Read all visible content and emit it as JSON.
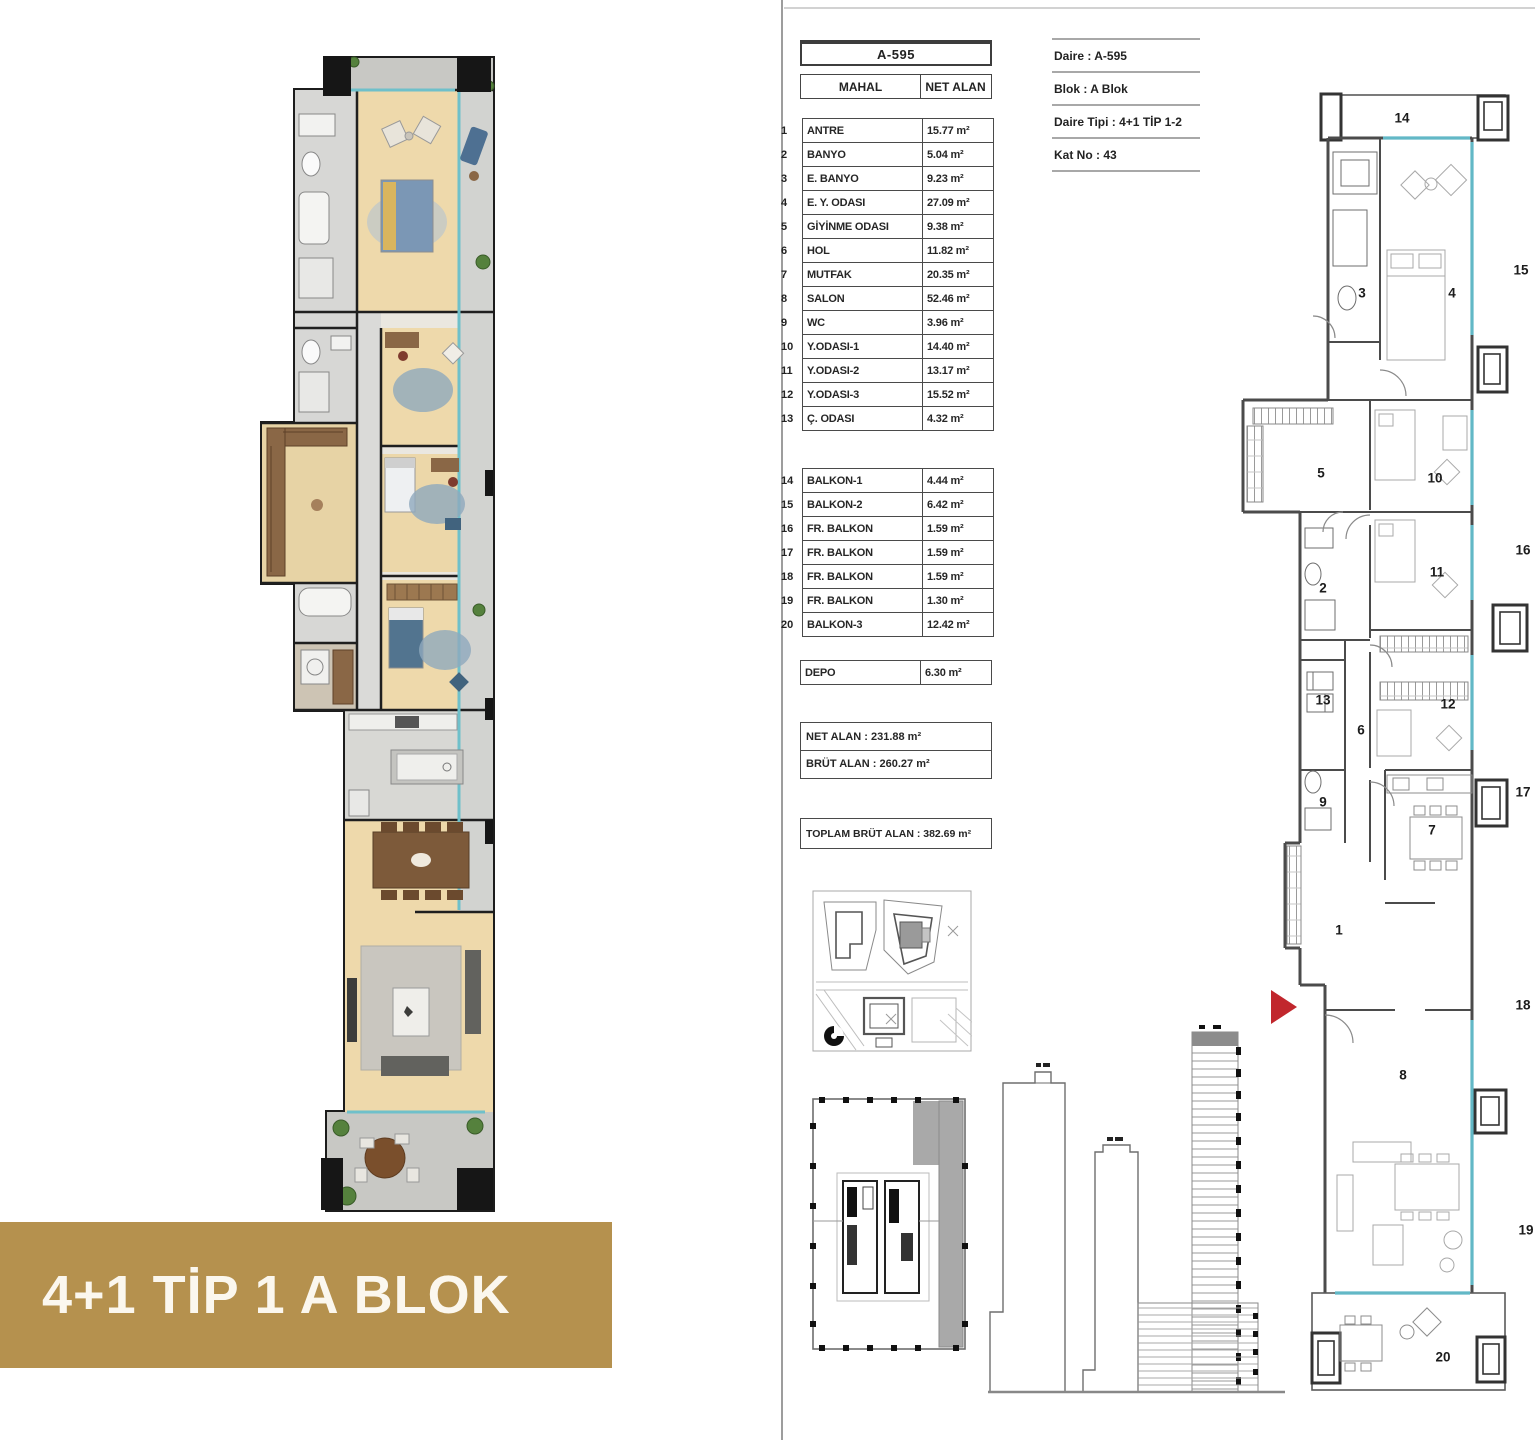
{
  "banner": {
    "text": "4+1 TİP 1  A BLOK",
    "bg": "#b5914e",
    "fg": "#fbf7ee"
  },
  "room_table": {
    "unit_code": "A-595",
    "columns": {
      "mahal": "MAHAL",
      "net_alan": "NET ALAN"
    },
    "rows": [
      {
        "no": "1",
        "name": "ANTRE",
        "area": "15.77 m²"
      },
      {
        "no": "2",
        "name": "BANYO",
        "area": "5.04 m²"
      },
      {
        "no": "3",
        "name": "E. BANYO",
        "area": "9.23 m²"
      },
      {
        "no": "4",
        "name": "E. Y. ODASI",
        "area": "27.09 m²"
      },
      {
        "no": "5",
        "name": "GİYİNME ODASI",
        "area": "9.38 m²"
      },
      {
        "no": "6",
        "name": "HOL",
        "area": "11.82 m²"
      },
      {
        "no": "7",
        "name": "MUTFAK",
        "area": "20.35 m²"
      },
      {
        "no": "8",
        "name": "SALON",
        "area": "52.46 m²"
      },
      {
        "no": "9",
        "name": "WC",
        "area": "3.96 m²"
      },
      {
        "no": "10",
        "name": "Y.ODASI-1",
        "area": "14.40 m²"
      },
      {
        "no": "11",
        "name": "Y.ODASI-2",
        "area": "13.17 m²"
      },
      {
        "no": "12",
        "name": "Y.ODASI-3",
        "area": "15.52 m²"
      },
      {
        "no": "13",
        "name": "Ç. ODASI",
        "area": "4.32 m²"
      }
    ],
    "balcony_rows": [
      {
        "no": "14",
        "name": "BALKON-1",
        "area": "4.44 m²"
      },
      {
        "no": "15",
        "name": "BALKON-2",
        "area": "6.42 m²"
      },
      {
        "no": "16",
        "name": "FR. BALKON",
        "area": "1.59 m²"
      },
      {
        "no": "17",
        "name": "FR. BALKON",
        "area": "1.59 m²"
      },
      {
        "no": "18",
        "name": "FR. BALKON",
        "area": "1.59 m²"
      },
      {
        "no": "19",
        "name": "FR. BALKON",
        "area": "1.30 m²"
      },
      {
        "no": "20",
        "name": "BALKON-3",
        "area": "12.42 m²"
      }
    ],
    "depo_row": {
      "name": "DEPO",
      "area": "6.30 m²"
    },
    "summary": {
      "net": "NET ALAN : 231.88 m²",
      "brut": "BRÜT ALAN : 260.27 m²",
      "toplam": "TOPLAM BRÜT ALAN : 382.69 m²"
    }
  },
  "info_panel": {
    "daire": "Daire : A-595",
    "blok": "Blok : A Blok",
    "daire_tipi": "Daire Tipi : 4+1 TİP 1-2",
    "kat_no": "Kat No : 43"
  },
  "right_plan": {
    "entrance_color": "#c1272d",
    "labels": [
      {
        "t": "14",
        "x": 207,
        "y": 38
      },
      {
        "t": "15",
        "x": 326,
        "y": 190
      },
      {
        "t": "3",
        "x": 167,
        "y": 213
      },
      {
        "t": "4",
        "x": 257,
        "y": 213
      },
      {
        "t": "5",
        "x": 126,
        "y": 393
      },
      {
        "t": "10",
        "x": 240,
        "y": 398
      },
      {
        "t": "2",
        "x": 128,
        "y": 508
      },
      {
        "t": "11",
        "x": 242,
        "y": 492
      },
      {
        "t": "16",
        "x": 328,
        "y": 470
      },
      {
        "t": "13",
        "x": 128,
        "y": 620
      },
      {
        "t": "6",
        "x": 166,
        "y": 650
      },
      {
        "t": "12",
        "x": 253,
        "y": 624
      },
      {
        "t": "9",
        "x": 128,
        "y": 722
      },
      {
        "t": "7",
        "x": 237,
        "y": 750
      },
      {
        "t": "17",
        "x": 328,
        "y": 712
      },
      {
        "t": "1",
        "x": 144,
        "y": 850
      },
      {
        "t": "8",
        "x": 208,
        "y": 995
      },
      {
        "t": "18",
        "x": 328,
        "y": 925
      },
      {
        "t": "19",
        "x": 331,
        "y": 1150
      },
      {
        "t": "20",
        "x": 248,
        "y": 1277
      }
    ]
  }
}
